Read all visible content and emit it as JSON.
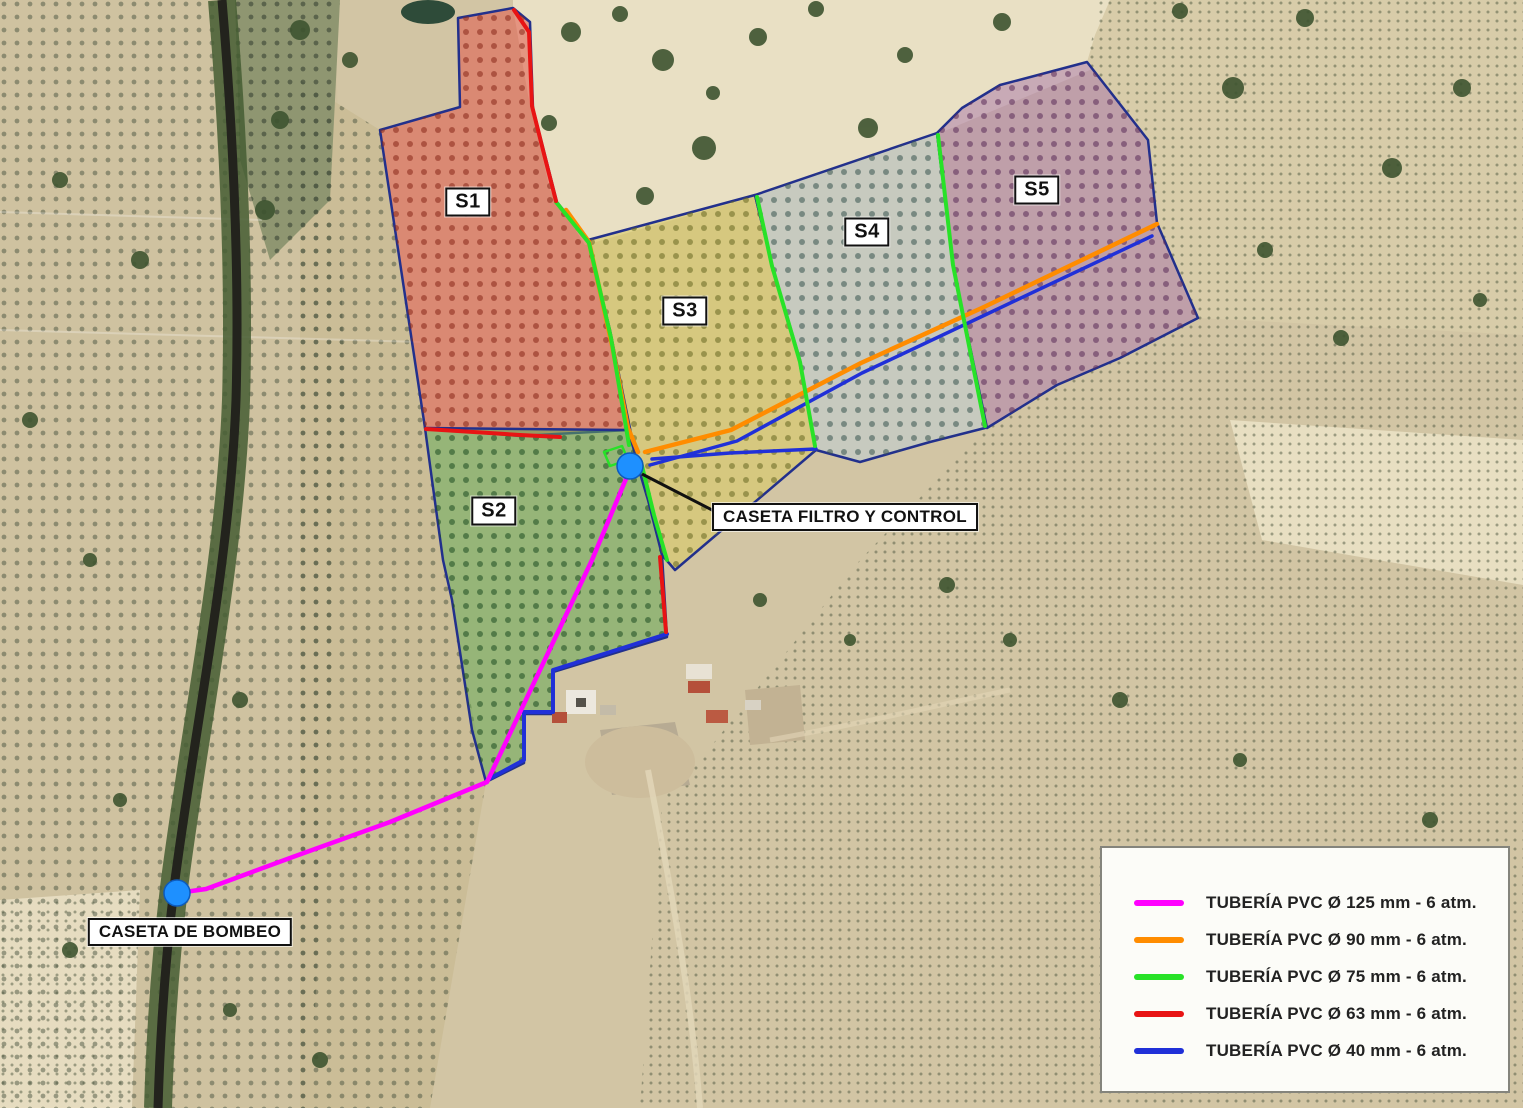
{
  "map": {
    "labels": {
      "filter_control": "CASETA FILTRO Y CONTROL",
      "pumping_station": "CASETA DE BOMBEO"
    },
    "sectors": [
      {
        "label": "S1",
        "color": "#e0584a",
        "dot_color": "#8a2a1a"
      },
      {
        "label": "S2",
        "color": "#64a854",
        "dot_color": "#1f4d22"
      },
      {
        "label": "S3",
        "color": "#d9ca68",
        "dot_color": "#6a6a24"
      },
      {
        "label": "S4",
        "color": "#bfcdd2",
        "dot_color": "#3a5652"
      },
      {
        "label": "S5",
        "color": "#b286ae",
        "dot_color": "#5c2c58"
      }
    ],
    "pipes": [
      {
        "label": "TUBERÍA PVC Ø 125 mm - 6 atm.",
        "diameter_mm": 125,
        "pressure": "6 atm",
        "color": "#ff00ff"
      },
      {
        "label": "TUBERÍA PVC Ø 90 mm - 6 atm.",
        "diameter_mm": 90,
        "pressure": "6 atm",
        "color": "#ff8c00"
      },
      {
        "label": "TUBERÍA PVC Ø 75 mm - 6 atm.",
        "diameter_mm": 75,
        "pressure": "6 atm",
        "color": "#28e228"
      },
      {
        "label": "TUBERÍA PVC Ø 63 mm - 6 atm.",
        "diameter_mm": 63,
        "pressure": "6 atm",
        "color": "#e81414"
      },
      {
        "label": "TUBERÍA PVC Ø 40 mm - 6 atm.",
        "diameter_mm": 40,
        "pressure": "6 atm",
        "color": "#2030d8"
      }
    ],
    "markers": {
      "color": "#1e90ff",
      "edge_color": "#0d5bbd"
    },
    "outline_color": "#22308c"
  }
}
